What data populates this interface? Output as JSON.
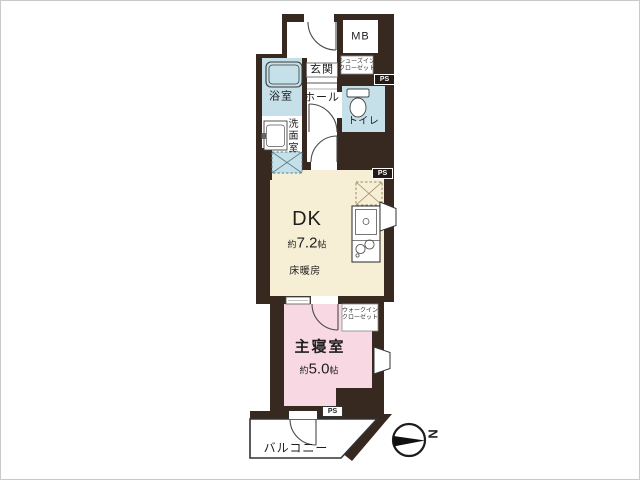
{
  "floorplan": {
    "labels": {
      "mb": "MB",
      "genkan": "玄関",
      "shoes_closet_line1": "シューズイン",
      "shoes_closet_line2": "クローゼット",
      "ps": "PS",
      "bath": "浴室",
      "washroom": "洗面室",
      "hall": "ホール",
      "toilet": "トイレ",
      "dk": "DK",
      "dk_area_prefix": "約",
      "dk_area_value": "7.2",
      "dk_area_suffix": "帖",
      "floor_heating": "床暖房",
      "wic_line1": "ウォークイン",
      "wic_line2": "クローゼット",
      "bedroom": "主寝室",
      "bedroom_area_prefix": "約",
      "bedroom_area_value": "5.0",
      "bedroom_area_suffix": "帖",
      "balcony": "バルコニー",
      "compass_north": "N"
    },
    "colors": {
      "wall": "#37291f",
      "wet_room": "#c5e0e8",
      "dk_floor": "#f6eed5",
      "bedroom_floor": "#f8d8e3"
    }
  }
}
